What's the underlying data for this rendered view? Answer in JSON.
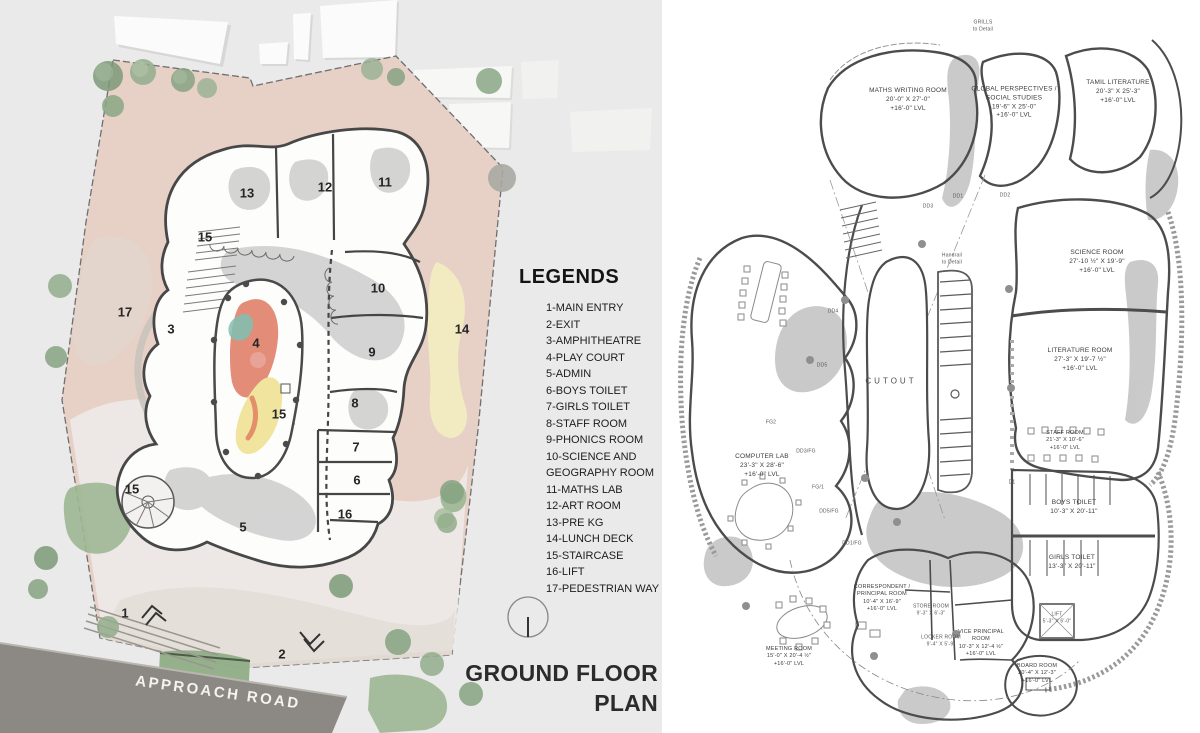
{
  "left_panel": {
    "legend": {
      "title": "LEGENDS",
      "items": [
        {
          "t": "1-MAIN ENTRY"
        },
        {
          "t": "2-EXIT"
        },
        {
          "t": "3-AMPHITHEATRE"
        },
        {
          "t": "4-PLAY COURT"
        },
        {
          "t": "5-ADMIN"
        },
        {
          "t": "6-BOYS TOILET"
        },
        {
          "t": "7-GIRLS TOILET"
        },
        {
          "t": "8-STAFF ROOM"
        },
        {
          "t": "9-PHONICS ROOM"
        },
        {
          "t": "10-SCIENCE AND GEOGRAPHY ROOM"
        },
        {
          "t": "11-MATHS LAB"
        },
        {
          "t": "12-ART ROOM"
        },
        {
          "t": "13-PRE KG"
        },
        {
          "t": "14-LUNCH DECK"
        },
        {
          "t": "15-STAIRCASE"
        },
        {
          "t": "16-LIFT"
        },
        {
          "t": "17-PEDESTRIAN WAY"
        }
      ]
    },
    "title": "GROUND FLOOR PLAN",
    "road_label": "APPROACH ROAD",
    "markers": [
      {
        "t": "13",
        "x": 247,
        "y": 193
      },
      {
        "t": "12",
        "x": 325,
        "y": 187
      },
      {
        "t": "11",
        "x": 385,
        "y": 182
      },
      {
        "t": "15",
        "x": 205,
        "y": 237
      },
      {
        "t": "10",
        "x": 378,
        "y": 288
      },
      {
        "t": "17",
        "x": 125,
        "y": 312
      },
      {
        "t": "3",
        "x": 171,
        "y": 329
      },
      {
        "t": "4",
        "x": 256,
        "y": 343
      },
      {
        "t": "14",
        "x": 462,
        "y": 329
      },
      {
        "t": "9",
        "x": 372,
        "y": 352
      },
      {
        "t": "8",
        "x": 355,
        "y": 403
      },
      {
        "t": "15",
        "x": 279,
        "y": 414
      },
      {
        "t": "7",
        "x": 356,
        "y": 447
      },
      {
        "t": "6",
        "x": 357,
        "y": 480
      },
      {
        "t": "16",
        "x": 345,
        "y": 514
      },
      {
        "t": "15",
        "x": 132,
        "y": 489
      },
      {
        "t": "5",
        "x": 243,
        "y": 527
      },
      {
        "t": "1",
        "x": 125,
        "y": 613
      },
      {
        "t": "2",
        "x": 282,
        "y": 654
      }
    ]
  },
  "right_panel": {
    "labels": [
      {
        "x": 908,
        "y": 100,
        "l1": "MATHS WRITING ROOM",
        "l2": "20'-0\" X 27'-0\"",
        "l3": "+16'-0\" LVL"
      },
      {
        "x": 1014,
        "y": 103,
        "l1": "GLOBAL PERSPECTIVES /",
        "l2": "SOCIAL STUDIES",
        "l3": "19'-6\" X 25'-0\"",
        "l4": "+16'-0\" LVL"
      },
      {
        "x": 1118,
        "y": 92,
        "l1": "TAMIL LITERATURE",
        "l2": "20'-3\" X 25'-3\"",
        "l3": "+16'-0\" LVL"
      },
      {
        "x": 1097,
        "y": 262,
        "l1": "SCIENCE ROOM",
        "l2": "27'-10 ½\" X 19'-9\"",
        "l3": "+16'-0\" LVL"
      },
      {
        "x": 1080,
        "y": 360,
        "l1": "LITERATURE ROOM",
        "l2": "27'-3\" X 19'-7 ½\"",
        "l3": "+16'-0\" LVL"
      },
      {
        "x": 891,
        "y": 382,
        "cls": "cutout",
        "l1": "CUTOUT"
      },
      {
        "x": 762,
        "y": 466,
        "l1": "COMPUTER LAB",
        "l2": "23'-3\" X 28'-6\"",
        "l3": "+16'-0\" LVL"
      },
      {
        "x": 1065,
        "y": 441,
        "cls": "small",
        "l1": "STAFF ROOM",
        "l2": "21'-3\" X 10'-6\"",
        "l3": "+16'-0\" LVL"
      },
      {
        "x": 1074,
        "y": 508,
        "l1": "BOYS TOILET",
        "l2": "10'-3\" X 20'-11\""
      },
      {
        "x": 1072,
        "y": 563,
        "l1": "GIRLS TOILET",
        "l2": "13'-3\" X 20'-11\""
      },
      {
        "x": 1057,
        "y": 618,
        "cls": "tag",
        "l1": "LIFT",
        "l2": "5'-3\" X 6'-0\""
      },
      {
        "x": 882,
        "y": 599,
        "cls": "small",
        "l1": "CORRESPONDENT /",
        "l2": "PRINCIPAL ROOM",
        "l3": "10'-4\" X 16'-9\"",
        "l4": "+16'-0\" LVL"
      },
      {
        "x": 931,
        "y": 610,
        "cls": "tag",
        "l1": "STORE ROOM",
        "l2": "9'-3\" X 6'-3\""
      },
      {
        "x": 941,
        "y": 641,
        "cls": "tag",
        "l1": "LOCKER ROOM",
        "l2": "9'-4\" X 5'-9\""
      },
      {
        "x": 981,
        "y": 644,
        "cls": "small",
        "l1": "VICE PRINCIPAL",
        "l2": "ROOM",
        "l3": "10'-3\" X 12'-4 ½\"",
        "l4": "+16'-0\" LVL"
      },
      {
        "x": 789,
        "y": 657,
        "cls": "small",
        "l1": "MEETING ROOM",
        "l2": "15'-0\" X 20'-4 ½\"",
        "l3": "+16'-0\" LVL"
      },
      {
        "x": 1037,
        "y": 674,
        "cls": "small",
        "l1": "BOARD ROOM",
        "l2": "20'-4\" X 12'-3\"",
        "l3": "+16'-0\" LVL"
      },
      {
        "x": 983,
        "y": 26,
        "cls": "tag",
        "l1": "GRILLS",
        "l2": "to Detail"
      },
      {
        "x": 952,
        "y": 259,
        "cls": "tag",
        "l1": "Handrail",
        "l2": "to Detail"
      },
      {
        "x": 958,
        "y": 197,
        "cls": "tag",
        "l1": "DD1"
      },
      {
        "x": 1005,
        "y": 196,
        "cls": "tag",
        "l1": "DD2"
      },
      {
        "x": 928,
        "y": 207,
        "cls": "tag",
        "l1": "DD3"
      },
      {
        "x": 833,
        "y": 312,
        "cls": "tag",
        "l1": "DD4"
      },
      {
        "x": 822,
        "y": 366,
        "cls": "tag",
        "l1": "DD5"
      },
      {
        "x": 806,
        "y": 452,
        "cls": "tag",
        "l1": "DD3/FG"
      },
      {
        "x": 818,
        "y": 488,
        "cls": "tag",
        "l1": "FG/1"
      },
      {
        "x": 829,
        "y": 512,
        "cls": "tag",
        "l1": "DD5/FG"
      },
      {
        "x": 852,
        "y": 544,
        "cls": "tag",
        "l1": "DD1/FG"
      },
      {
        "x": 771,
        "y": 423,
        "cls": "tag",
        "l1": "FG2"
      },
      {
        "x": 1012,
        "y": 483,
        "cls": "tag",
        "l1": "D1"
      }
    ]
  },
  "colors": {
    "panel_bg": "#eaeaea",
    "paving_pink": "#e7d1c7",
    "road_gray": "#8c8984",
    "lunch_deck_yellow": "#f2ebc1",
    "play_red": "#e08068",
    "play_yellow": "#f1e49e",
    "play_teal": "#7fbfb2",
    "wall_dark": "#474747",
    "poche_gray": "#c5c5c5",
    "tree_green": "#86a381"
  }
}
